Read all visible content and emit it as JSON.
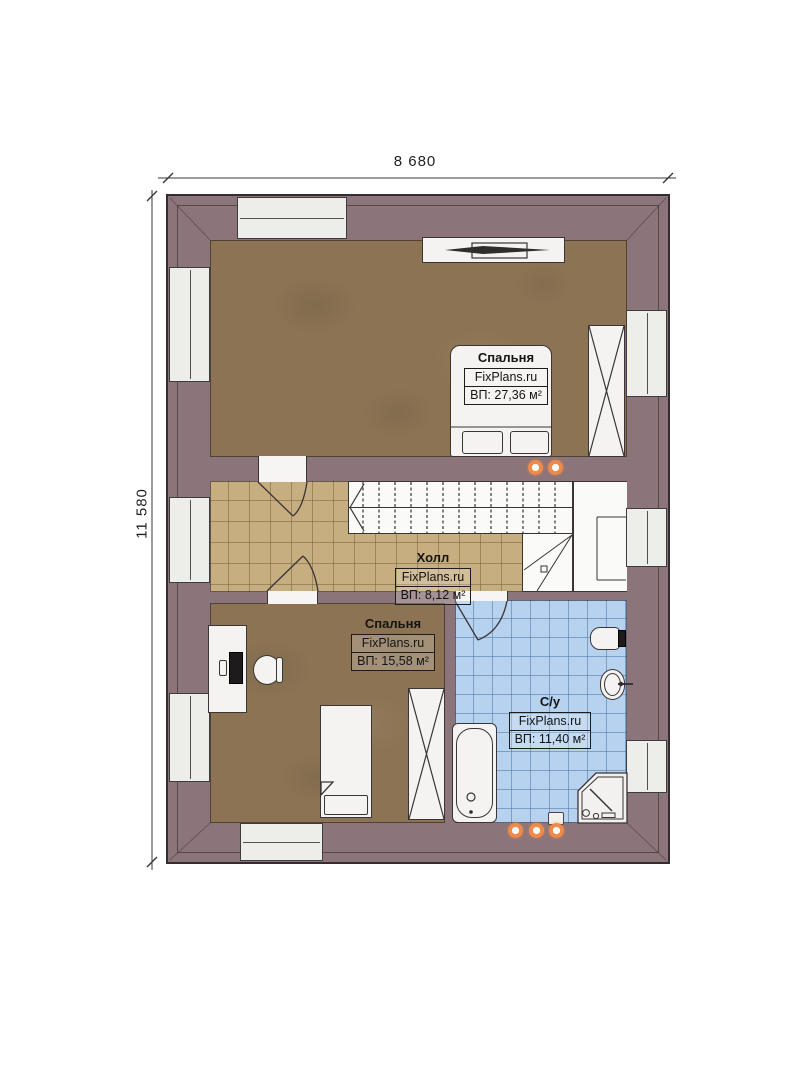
{
  "title": "Floor plan",
  "dimensions": {
    "width": "8 680",
    "height": "11 580"
  },
  "rooms": [
    {
      "name": "Спальня",
      "brand": "FixPlans.ru",
      "area": "ВП: 27,36 м²"
    },
    {
      "name": "Холл",
      "brand": "FixPlans.ru",
      "area": "ВП: 8,12 м²"
    },
    {
      "name": "Спальня",
      "brand": "FixPlans.ru",
      "area": "ВП: 15,58 м²"
    },
    {
      "name": "С/у",
      "brand": "FixPlans.ru",
      "area": "ВП: 11,40 м²"
    }
  ],
  "colors": {
    "wall": "#8c757a",
    "floor_wood": "#8b7353",
    "floor_tile_hall": "#c7ae80",
    "floor_tile_bath": "#b6d2ef",
    "fixture_white": "#f4f3f1",
    "accent_orange": "#ef8a4b"
  }
}
